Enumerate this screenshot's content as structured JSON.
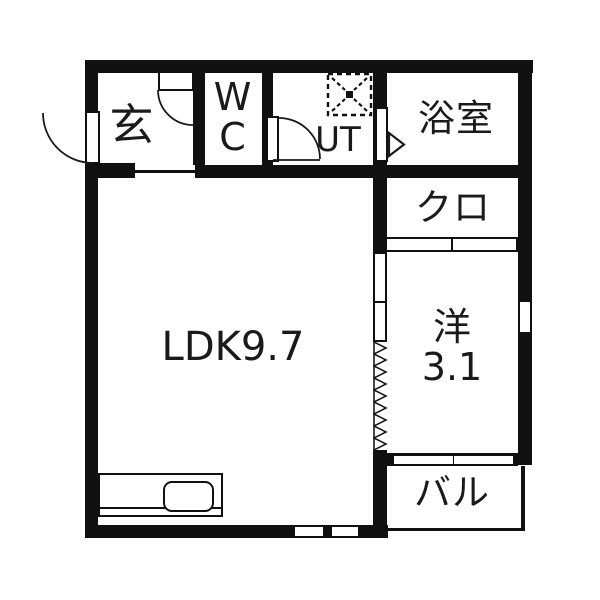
{
  "colors": {
    "wall": "#111111",
    "floor": "#ffffff",
    "line": "#1a1a1a"
  },
  "rooms": {
    "genkan": {
      "label": "玄"
    },
    "wc": {
      "label": "WC"
    },
    "ut": {
      "label": "UT"
    },
    "bathroom": {
      "label": "浴室"
    },
    "closet": {
      "label": "クロ"
    },
    "ldk": {
      "label": "LDK9.7"
    },
    "western": {
      "label": "洋3.1"
    },
    "balcony": {
      "label": "バル"
    }
  },
  "fixtures": {
    "washing_machine": "washing-machine-pan-icon",
    "kitchen_sink": "kitchen-sink-icon",
    "doors": [
      "entrance-swing-door",
      "wc-swing-door",
      "ut-swing-door",
      "bathroom-folding-door",
      "closet-sliding-door",
      "accordion-partition",
      "balcony-sliding-window"
    ]
  }
}
